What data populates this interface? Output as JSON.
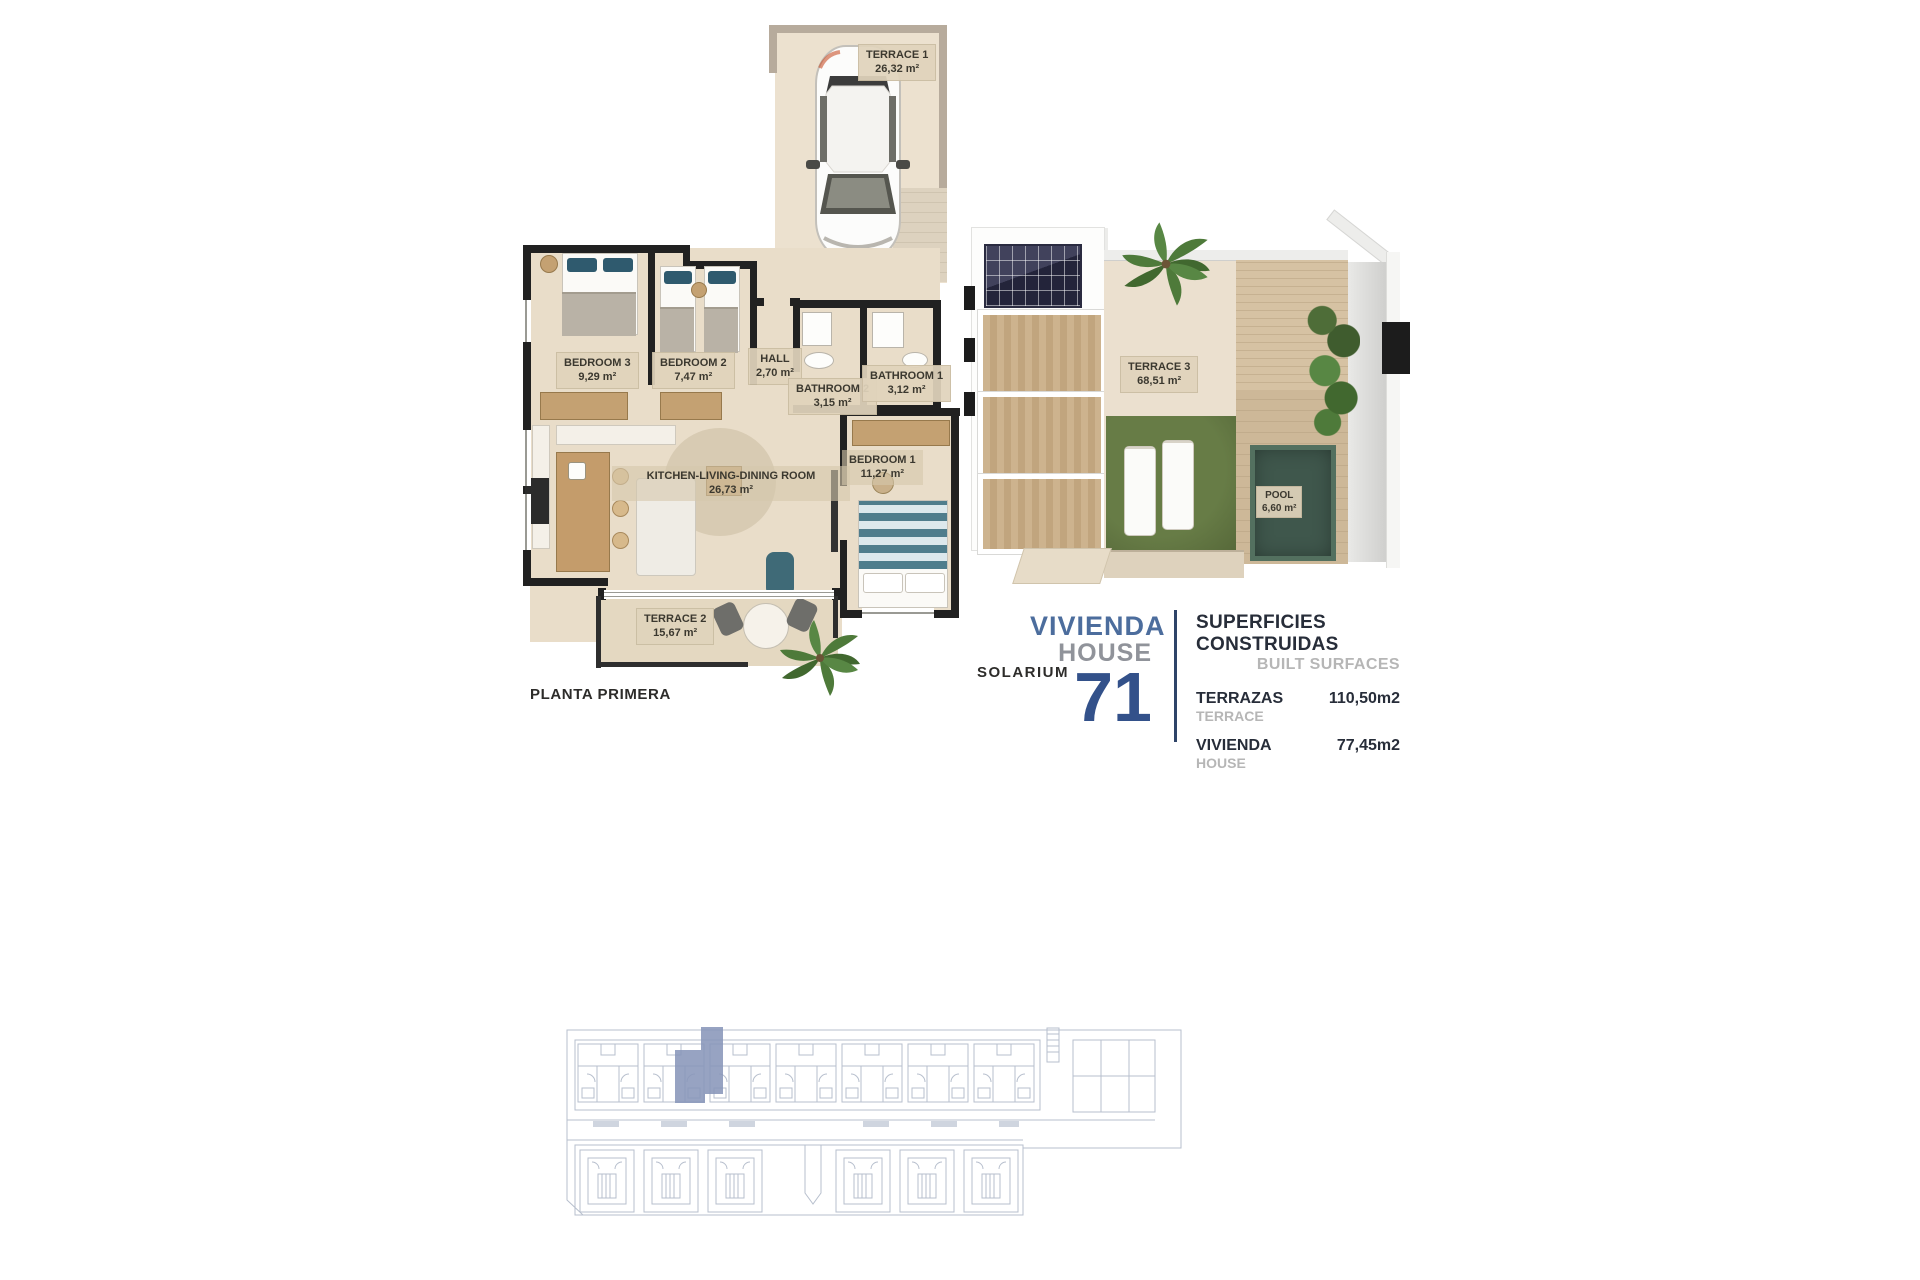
{
  "plans": {
    "first_floor": {
      "caption": "PLANTA PRIMERA",
      "terrace1": {
        "name": "TERRACE 1",
        "area": "26,32 m²"
      },
      "bedroom3": {
        "name": "BEDROOM 3",
        "area": "9,29 m²"
      },
      "bedroom2": {
        "name": "BEDROOM 2",
        "area": "7,47 m²"
      },
      "hall": {
        "name": "HALL",
        "area": "2,70 m²"
      },
      "bathroom2": {
        "name": "BATHROOM 2",
        "area": "3,15 m²"
      },
      "bathroom1": {
        "name": "BATHROOM 1",
        "area": "3,12 m²"
      },
      "kitchen": {
        "name": "KITCHEN-LIVING-DINING ROOM",
        "area": "26,73 m²"
      },
      "bedroom1": {
        "name": "BEDROOM 1",
        "area": "11,27 m²"
      },
      "terrace2": {
        "name": "TERRACE 2",
        "area": "15,67 m²"
      }
    },
    "solarium": {
      "caption": "SOLARIUM",
      "terrace3": {
        "name": "TERRACE 3",
        "area": "68,51 m²"
      },
      "pool": {
        "name": "POOL",
        "area": "6,60 m²"
      }
    }
  },
  "unit": {
    "vivienda_label": "VIVIENDA",
    "house_label": "HOUSE",
    "number": "71"
  },
  "surfaces": {
    "title_es": "SUPERFICIES CONSTRUIDAS",
    "title_en": "BUILT SURFACES",
    "rows": [
      {
        "label_es": "TERRAZAS",
        "label_en": "TERRACE",
        "value": "110,50m2"
      },
      {
        "label_es": "VIVIENDA",
        "label_en": "HOUSE",
        "value": "77,45m2"
      }
    ]
  },
  "colors": {
    "accent_blue": "#33518a",
    "navy_text": "#272d39",
    "gray_text": "#b6b6b6",
    "floor_beige": "#e9ddc9",
    "grass_green": "#5f7440",
    "pool_green": "#3f574c",
    "siteplan_line": "#b7bfcd",
    "siteplan_highlight": "#8996ba"
  }
}
